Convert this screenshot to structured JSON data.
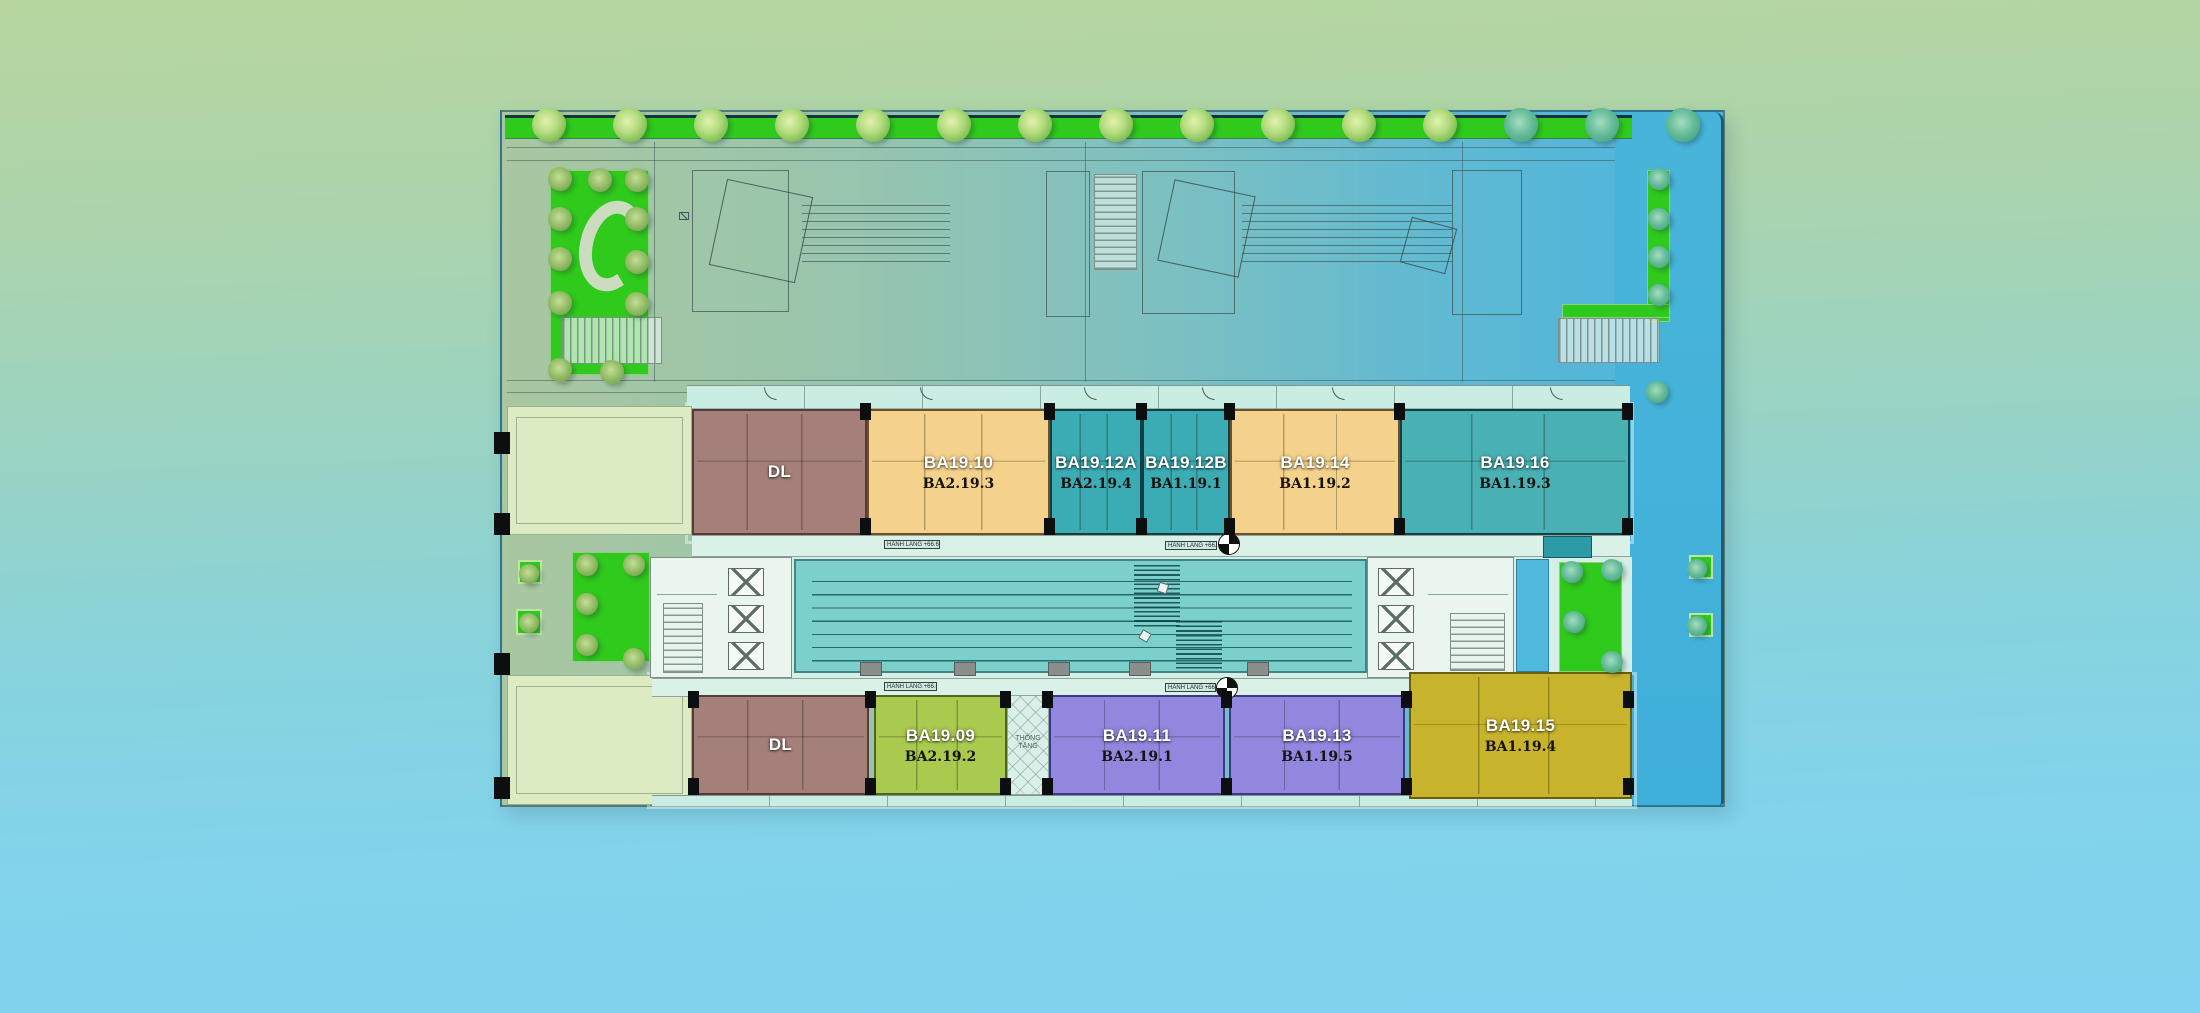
{
  "background": {
    "top_color": "#b7d69e",
    "bottom_color": "#7fd2ee"
  },
  "corridor": {
    "label": "HÀNH LANG +66.650"
  },
  "void": {
    "label": "THÔNG TẦNG"
  },
  "units_top": [
    {
      "name": "DL",
      "code": "",
      "fill": "#a5807b",
      "wall": "#563c34"
    },
    {
      "name": "BA19.10",
      "code": "BA2.19.3",
      "fill": "#f5d28b",
      "wall": "#6e4f26"
    },
    {
      "name": "BA19.12A",
      "code": "BA2.19.4",
      "fill": "#3cacb4",
      "wall": "#123f46"
    },
    {
      "name": "BA19.12B",
      "code": "BA1.19.1",
      "fill": "#3cacb4",
      "wall": "#123f46"
    },
    {
      "name": "BA19.14",
      "code": "BA1.19.2",
      "fill": "#f5d28b",
      "wall": "#6e4f26"
    },
    {
      "name": "BA19.16",
      "code": "BA1.19.3",
      "fill": "#49b0b4",
      "wall": "#123f46"
    }
  ],
  "units_bottom": [
    {
      "name": "DL",
      "code": "",
      "fill": "#a5807b",
      "wall": "#563c34"
    },
    {
      "name": "BA19.09",
      "code": "BA2.19.2",
      "fill": "#a9ca4f",
      "wall": "#4f641c"
    },
    {
      "name": "BA19.11",
      "code": "BA2.19.1",
      "fill": "#9187de",
      "wall": "#3f3787"
    },
    {
      "name": "BA19.13",
      "code": "BA1.19.5",
      "fill": "#9187de",
      "wall": "#3f3787"
    },
    {
      "name": "BA19.15",
      "code": "BA1.19.4",
      "fill": "#c8b42c",
      "wall": "#6b5d0e"
    }
  ],
  "palette": {
    "garden_green": "#2fca1c",
    "pool_teal": "#7bd0cb",
    "right_strip_blue": "#45b3d9",
    "corridor_mint": "#d9f1e7",
    "terrace_pale": "#dcebc2"
  }
}
